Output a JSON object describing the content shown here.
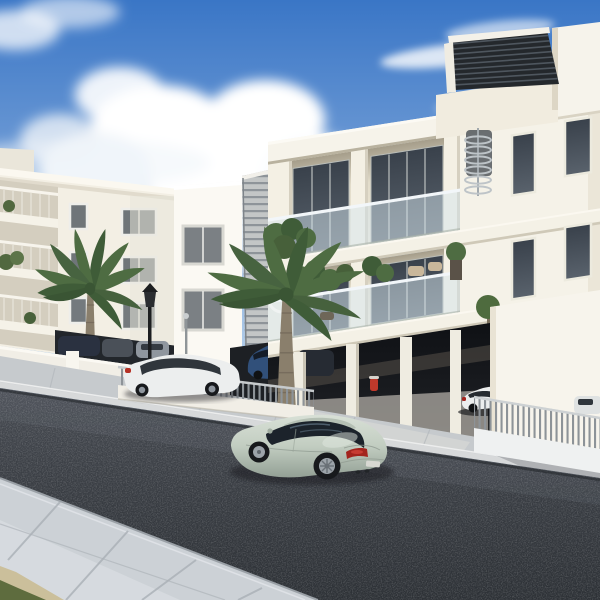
{
  "scene": {
    "type": "3d-architectural-render",
    "subject": "Modern white apartment buildings along a street with parked cars, palm trees and a sage-green coupe in the foreground",
    "sky": "blue sky with a large cumulus cloud left of center and thin wispy clouds on the right",
    "watermark_glyph": "O"
  },
  "colors": {
    "sky_top": "#3a76c6",
    "sky_mid": "#7fa7da",
    "sky_horizon": "#d3e4f4",
    "cloud": "#ffffff",
    "cloud_shade": "#c9d6e4",
    "facade_white": "#f6f3ea",
    "facade_bright": "#fbf9f3",
    "facade_cream": "#f3efe4",
    "facade_shade": "#e4decd",
    "interior_shadow": "#a59d8a",
    "soffit": "#d9d3c3",
    "glass_dark": "#39414b",
    "glass_light": "#59626c",
    "glass_frame": "#eceade",
    "railing_glass": "#d4e4ec",
    "louver": "#c3c6c6",
    "louver_line": "#8e9499",
    "pergola": "#24282c",
    "pergola_slat": "#4e565e",
    "parking_dark": "#17191d",
    "parking_floor": "#97948e",
    "wall_white": "#f1eee6",
    "fence_bar": "#8d9398",
    "sidewalk_far": "#c6cacd",
    "sidewalk_near": "#ccd1d6",
    "curb": "#d7d9da",
    "joint": "#aab0b6",
    "asphalt": "#3a3e44",
    "driveway": "#d2d4d3",
    "grass": "#5e6c3e",
    "curb_tan": "#cbbf9b",
    "palm_frond": "#4e6c42",
    "palm_frond_dark": "#3f5c38",
    "palm_trunk": "#8a7f6c",
    "lamp_black": "#1c1e20",
    "hydrant_red": "#c0392b",
    "car_body_light": "#d8e0d6",
    "car_body": "#c2cdc1",
    "car_body_dark": "#93a095",
    "car_glass": "#1c232b",
    "car_tail": "#a3241e",
    "tire": "#17191c",
    "rim": "#9ca3a9",
    "white_car": "#eceeee",
    "suv_blue": "#31507a",
    "car_navy": "#2a3140",
    "car_gray": "#4a5058",
    "car_silver": "#8f969e",
    "shadow": "#1a1d22",
    "watermark": "#ffffff"
  },
  "objects": {
    "buildings": [
      "main apartment building with glass balconies and roof pergola",
      "stair tower with two large windows",
      "louvered staircase screen",
      "left apartment building with small windows and side balconies",
      "background building"
    ],
    "vehicles": [
      "sage-green coupe driving on street",
      "white hatchback parked at curb",
      "white sedan in ground-floor garage",
      "blue SUV in carport",
      "white car behind right fence",
      "dark cars in left garage"
    ],
    "vegetation": [
      "large palm tree",
      "small palm tree",
      "balcony plants",
      "potted topiary tree"
    ],
    "street_elements": [
      "asphalt road",
      "near paved sidewalk",
      "far paved sidewalk",
      "driveway apron",
      "metal picket fence left",
      "metal picket fence right",
      "street lantern",
      "bollard light",
      "red hydrant",
      "grass patch"
    ]
  }
}
